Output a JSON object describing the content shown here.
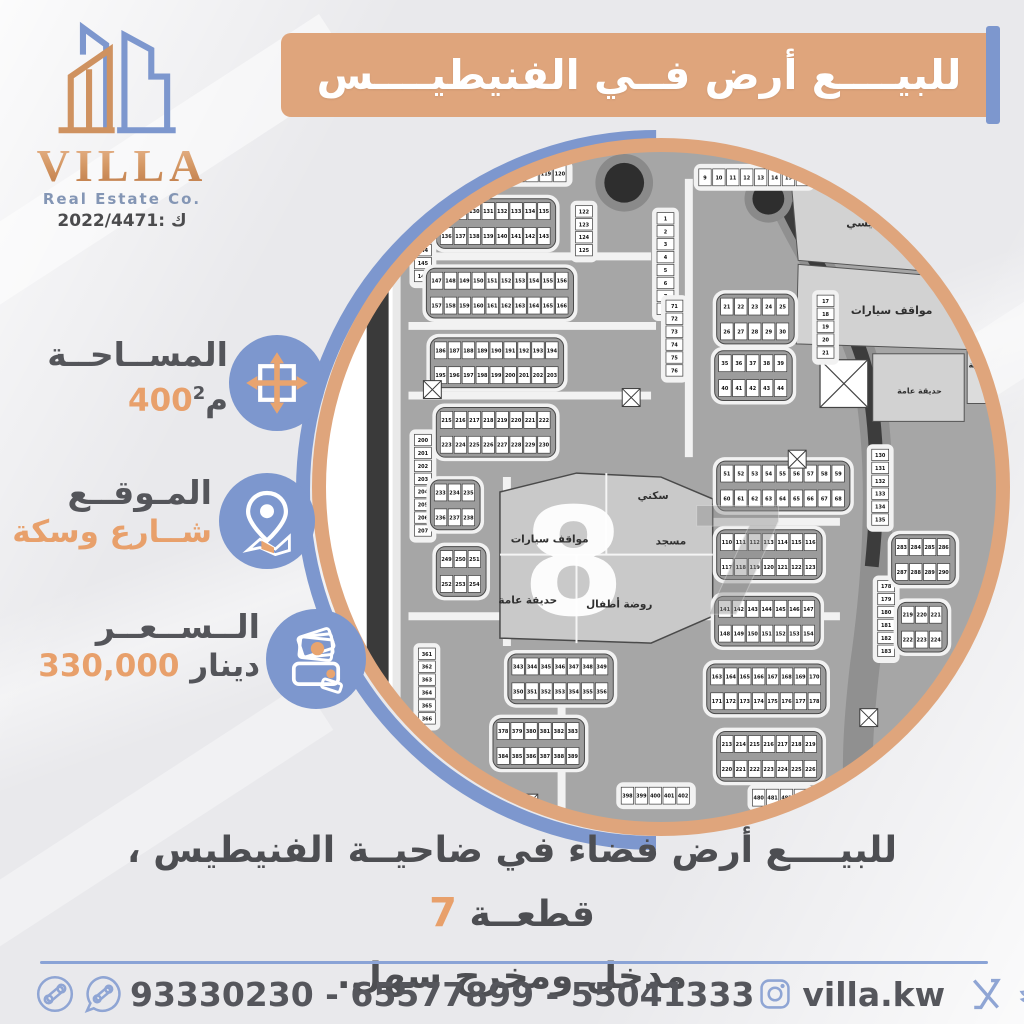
{
  "colors": {
    "orange": "#dfa57c",
    "orange_text": "#e8a06b",
    "blue": "#7d97ce",
    "blue_light": "#8fa5d4",
    "dark_text": "#4d4e52",
    "map_gray": "#a6a6a6"
  },
  "logo": {
    "name": "VILLA",
    "subtitle": "Real Estate Co.",
    "license": "2022/4471: ك"
  },
  "banner": {
    "title": "للبيــــع أرض فــي الفنيطيــــس"
  },
  "info": {
    "area": {
      "label": "المســاحــة",
      "value": "400",
      "unit": "م",
      "sup": "2"
    },
    "location": {
      "label": "المـوقــع",
      "value": "شــارع وسكة"
    },
    "price": {
      "label": "الــســعــر",
      "value": "330,000",
      "unit": "دينار"
    }
  },
  "description": {
    "line1": "للبيــــع أرض فضاء في ضاحيــة الفنيطيس ، قطعــة",
    "highlight": "7",
    "line2": "مدخل ومخرج سهل."
  },
  "footer": {
    "phones": "93330230 - 65577899 - 55041333",
    "instagram": "villa.kw",
    "handle": "villa_kw"
  },
  "map": {
    "watermark": "7",
    "landmark_number": "8",
    "landmark_labels": [
      "سكني",
      "مسجد",
      "مواقف سيارات",
      "روضة أطفال",
      "حديقة عامة"
    ],
    "parcel_labels": [
      "مسجد رئيسي",
      "مواقف سيارات",
      "حديقة عامة",
      "الابتدائية"
    ],
    "blocks": [
      [
        120,
        16,
        9,
        1,
        112
      ],
      [
        378,
        20,
        8,
        1,
        9
      ],
      [
        118,
        54,
        8,
        2,
        128
      ],
      [
        92,
        70,
        1,
        5,
        142
      ],
      [
        336,
        64,
        1,
        8,
        1
      ],
      [
        108,
        124,
        10,
        2,
        147
      ],
      [
        400,
        150,
        5,
        2,
        21
      ],
      [
        497,
        147,
        1,
        5,
        17
      ],
      [
        112,
        194,
        9,
        2,
        186
      ],
      [
        398,
        207,
        5,
        2,
        35
      ],
      [
        92,
        287,
        1,
        8,
        200
      ],
      [
        118,
        264,
        8,
        2,
        215
      ],
      [
        400,
        318,
        9,
        2,
        51
      ],
      [
        112,
        337,
        3,
        2,
        233
      ],
      [
        118,
        404,
        3,
        2,
        249
      ],
      [
        400,
        387,
        7,
        2,
        110
      ],
      [
        398,
        454,
        7,
        2,
        141
      ],
      [
        552,
        302,
        1,
        6,
        130
      ],
      [
        558,
        434,
        1,
        6,
        178
      ],
      [
        390,
        522,
        8,
        2,
        163
      ],
      [
        190,
        512,
        7,
        2,
        343
      ],
      [
        96,
        502,
        1,
        6,
        361
      ],
      [
        175,
        577,
        6,
        2,
        378
      ],
      [
        400,
        590,
        7,
        2,
        213
      ],
      [
        300,
        642,
        5,
        1,
        398
      ],
      [
        432,
        644,
        4,
        1,
        480
      ],
      [
        576,
        392,
        4,
        2,
        283
      ],
      [
        582,
        460,
        3,
        2,
        219
      ],
      [
        345,
        152,
        1,
        6,
        71
      ],
      [
        254,
        57,
        1,
        4,
        122
      ]
    ]
  }
}
